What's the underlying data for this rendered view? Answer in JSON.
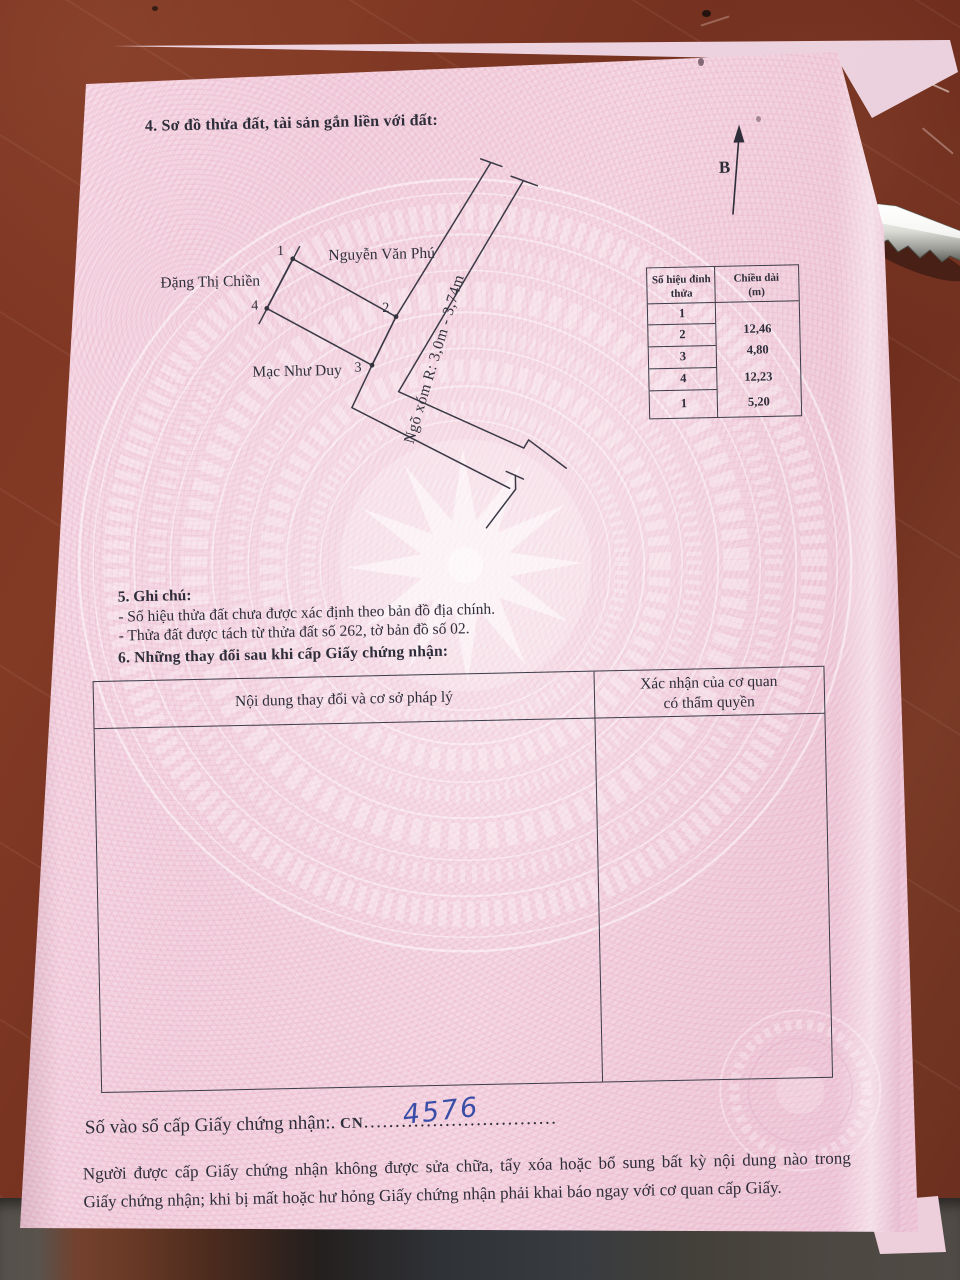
{
  "document": {
    "section4": {
      "title": "4. Sơ đồ thửa đất, tài sản gắn liền với đất:"
    },
    "compass": {
      "label": "B"
    },
    "plot_diagram": {
      "neighbor_west": "Đặng Thị Chiền",
      "neighbor_north": "Nguyễn Văn Phú",
      "neighbor_south": "Mạc Như Duy",
      "road_label": "Ngõ xóm R: 3,0m - 3,74m",
      "vertex_1": "1",
      "vertex_2": "2",
      "vertex_3": "3",
      "vertex_4": "4"
    },
    "edge_table": {
      "header_col1_line1": "Số hiệu đỉnh",
      "header_col1_line2": "thửa",
      "header_col2_line1": "Chiều dài",
      "header_col2_line2": "(m)",
      "vertex_ids": [
        "1",
        "2",
        "3",
        "4",
        "1"
      ],
      "lengths_m": [
        "12,46",
        "4,80",
        "12,23",
        "5,20"
      ]
    },
    "section5": {
      "title": "5. Ghi chú:",
      "note1": "- Số hiệu thửa đất chưa được xác định theo bản đồ địa chính.",
      "note2": "- Thửa đất được tách từ thửa đất số 262, tờ bản đồ số 02."
    },
    "section6": {
      "title": "6. Những thay đổi sau khi cấp Giấy chứng nhận:",
      "col1_header": "Nội dung thay đổi và cơ sở pháp lý",
      "col2_header_line1": "Xác nhận của cơ quan",
      "col2_header_line2": "có thẩm quyền"
    },
    "registry": {
      "label": "Số vào sổ cấp Giấy chứng nhận:.",
      "code_prefix": "CN",
      "number_handwritten": "4576",
      "leader_dots": "..............................."
    },
    "footer": {
      "line1": "Người được cấp Giấy chứng nhận không được sửa chữa, tẩy xóa hoặc bổ sung bất kỳ nội dung nào trong",
      "line2": "Giấy chứng nhận; khi bị mất hoặc hư hỏng Giấy chứng nhận phải khai báo ngay với cơ quan cấp Giấy."
    }
  },
  "colors": {
    "paper_pink": "#f4d6e2",
    "table_brown": "#7b3322",
    "ink": "#2e2d3a",
    "handwriting_blue": "#3a4ea8"
  }
}
